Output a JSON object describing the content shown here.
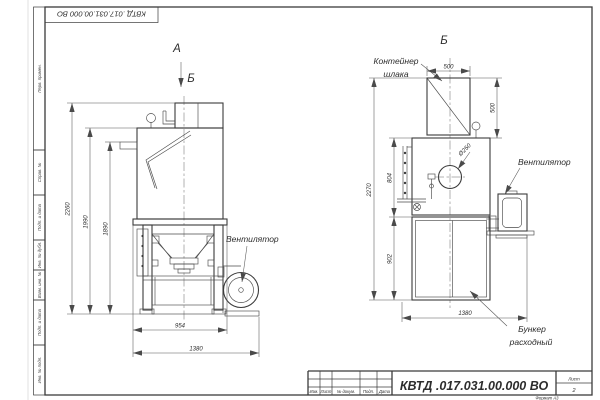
{
  "frame": {
    "top_stamp": "КВТД .017.031.00.000  ВО",
    "side_stamps": [
      "Перв. примен.",
      "Справ. №",
      "Подп. и дата",
      "Инв. № дубл.",
      "Взам. инв. №",
      "Подп. и дата",
      "Инв. № подл."
    ]
  },
  "views": {
    "left": {
      "label_a": "А",
      "label_b_marker": "Б",
      "callout_fan": "Вентилятор",
      "dims": {
        "total_height": "2260",
        "body_height": "1990",
        "inlet_height": "1890",
        "base_width": "954",
        "overall_width": "1380"
      }
    },
    "right": {
      "title": "Б",
      "callouts": {
        "container_line1": "Контейнер",
        "container_line2": "шлака",
        "fan": "Вентилятор",
        "bunker_line1": "Бункер",
        "bunker_line2": "расходный"
      },
      "dims": {
        "container_width": "500",
        "container_height": "500",
        "total_height": "2270",
        "upper_height": "804",
        "bunker_height": "902",
        "overall_width": "1380",
        "inlet_diameter": "Ø250"
      }
    }
  },
  "title_block": {
    "designation": "КВТД .017.031.00.000  ВО",
    "columns": [
      "Изм.",
      "Лист",
      "№ докум.",
      "Подп.",
      "Дата"
    ],
    "sheet_label": "Лист",
    "sheet_number": "2",
    "format_note": "Формат А3"
  }
}
